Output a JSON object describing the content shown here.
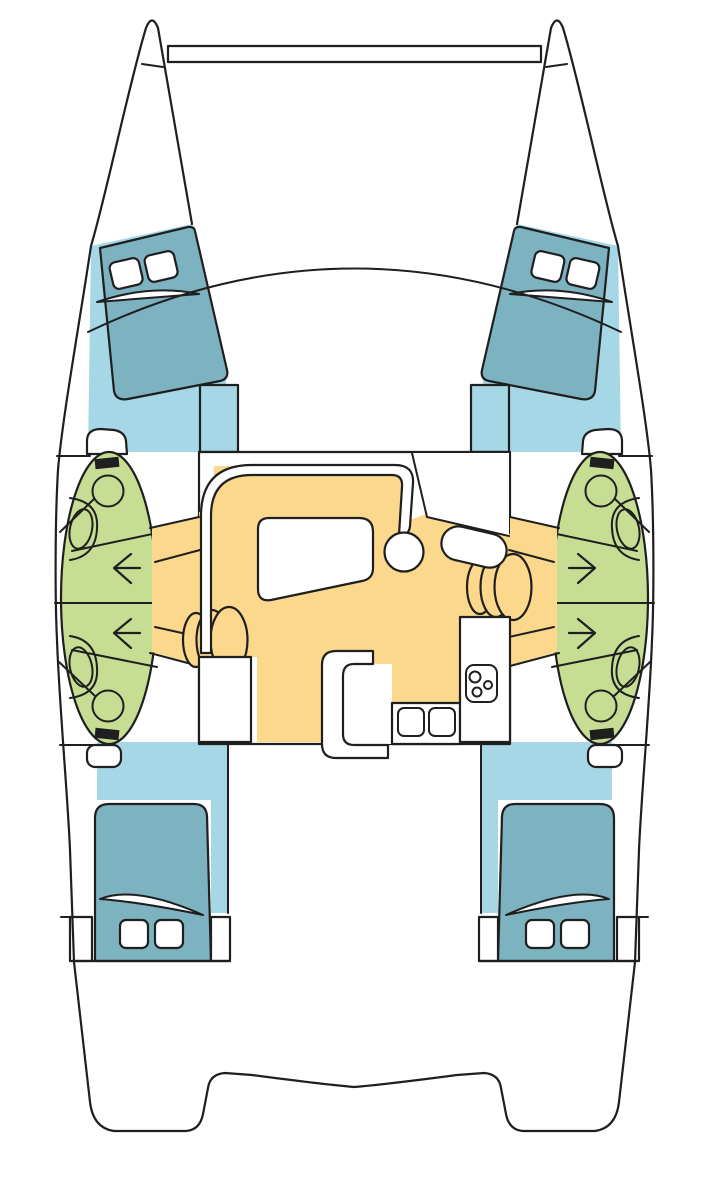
{
  "palette": {
    "outline": "#1f1f1f",
    "deck": "#ffffff",
    "sole": "#a6d7e7",
    "berth": "#7db3c1",
    "head": "#c7dd93",
    "salon": "#fbd88c",
    "tank": "#1f1f1f"
  },
  "diagram": {
    "title": "Catamaran interior layout — top-view floor plan",
    "vessel_type": "sailing catamaran",
    "view": "accommodation / deck plan"
  },
  "areas": {
    "bows": {
      "label": "Twin bows with forward crossbeam"
    },
    "port_forward_cabin": {
      "label": "Port forward cabin",
      "berth": "double berth",
      "hatch_count": 2
    },
    "starboard_forward_cabin": {
      "label": "Starboard forward cabin",
      "berth": "double berth",
      "hatch_count": 2
    },
    "port_head": {
      "label": "Port heads compartments",
      "toilet_count": 2,
      "sink_count": 2,
      "shower_pan_count": 1,
      "companionway_arrow_count": 2,
      "arrow_direction": "outboard-port"
    },
    "starboard_head": {
      "label": "Starboard heads compartments",
      "toilet_count": 2,
      "sink_count": 2,
      "shower_pan_count": 1,
      "companionway_arrow_count": 2,
      "arrow_direction": "outboard-starboard"
    },
    "salon": {
      "label": "Salon and galley on bridgedeck",
      "furniture": [
        "U-shaped settee",
        "dining table",
        "round end seat",
        "nav desk",
        "nav seat",
        "storage unit",
        "island counter",
        "double sink",
        "3-burner stove",
        "galley counter",
        "port companionway steps",
        "starboard companionway steps"
      ],
      "stove_burner_count": 3,
      "sink_count": 2,
      "step_count_per_side": 3
    },
    "port_aft_cabin": {
      "label": "Port aft cabin",
      "berth": "double berth",
      "hatch_count": 2
    },
    "starboard_aft_cabin": {
      "label": "Starboard aft cabin",
      "berth": "double berth",
      "hatch_count": 2
    },
    "stern": {
      "label": "Twin transoms joined by aft crossbeam"
    }
  }
}
